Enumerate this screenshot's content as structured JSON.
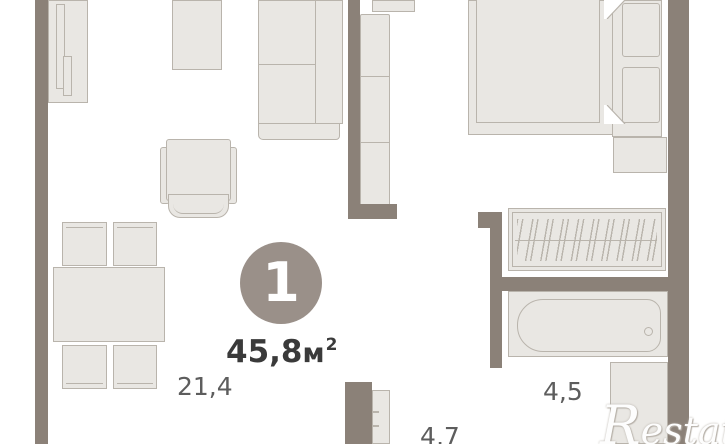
{
  "plan": {
    "unit_number": "1",
    "total_area": {
      "value": "45,8",
      "unit": "м",
      "sup": "2"
    },
    "rooms": [
      {
        "id": "living-room",
        "area": "21,4"
      },
      {
        "id": "bathroom",
        "area": "4,5"
      },
      {
        "id": "hallway",
        "area": "4,7"
      }
    ],
    "watermark": "Restate",
    "colors": {
      "wall": "#8b8178",
      "furniture-fill": "#e9e7e3",
      "furniture-fill-dark": "#e3e1dd",
      "furniture-border": "#b9b4ac",
      "badge": "#9a9089",
      "badge-text": "#ffffff",
      "area-text": "#3a3a3a",
      "label-text": "#5d5d5d",
      "bg": "#ffffff",
      "watermark-text": "#fdfdfd",
      "watermark-shadow": "#b5afa7"
    }
  }
}
